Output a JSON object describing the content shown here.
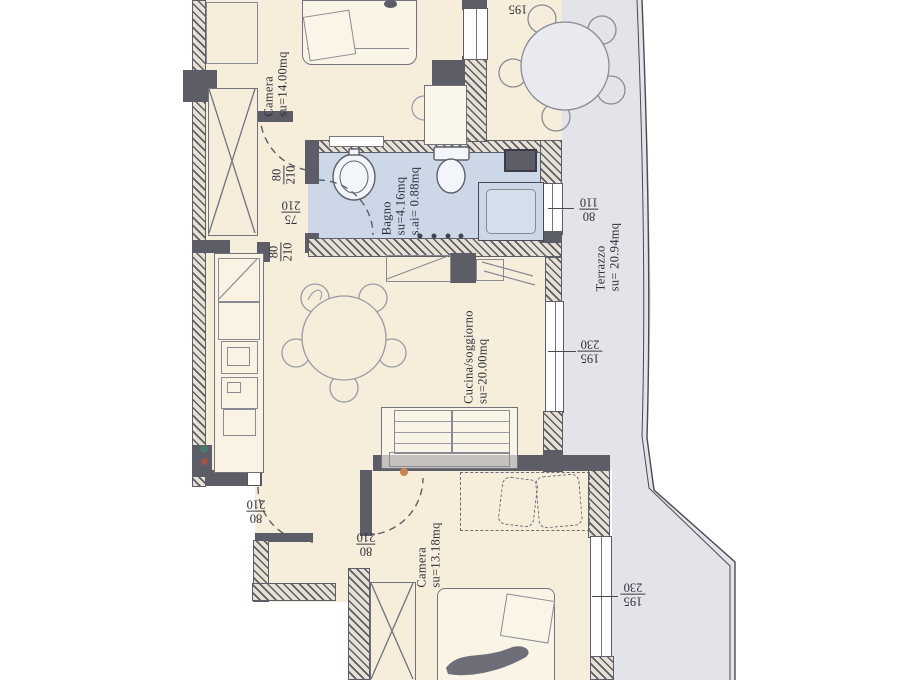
{
  "plan_type": "apartment-floor-plan",
  "rooms": {
    "camera1": {
      "name": "Camera",
      "area": "su=14.00mq"
    },
    "bagno": {
      "name": "Bagno",
      "area": "su=4.16mq",
      "area2": "s.ai= 0.88mq"
    },
    "cucina": {
      "name": "Cucina/soggiorno",
      "area": "su=20.00mq"
    },
    "camera2": {
      "name": "Camera",
      "area": "su=13.18mq"
    },
    "terrazzo": {
      "name": "Terrazzo",
      "area": "su= 20.94mq"
    }
  },
  "dims": {
    "door_camera1": {
      "num": "80",
      "den": "210"
    },
    "door_bagno": {
      "num": "75",
      "den": "210"
    },
    "door_cucina": {
      "num": "80",
      "den": "210"
    },
    "window_bagno": {
      "num": "80",
      "den": "110"
    },
    "window_cucina": {
      "num": "195",
      "den": "230"
    },
    "door_ingresso": {
      "num": "80",
      "den": "210"
    },
    "door_camera2": {
      "num": "80",
      "den": "210"
    },
    "window_camera2": {
      "num": "195",
      "den": "230"
    },
    "window_top": {
      "value": "195"
    }
  },
  "colors": {
    "room_fill": "#f6eedb",
    "bath_fill": "#ccd8e8",
    "terrace_fill": "#e3e4ea",
    "wall": "#5d5d68",
    "line": "#4a4a52"
  }
}
